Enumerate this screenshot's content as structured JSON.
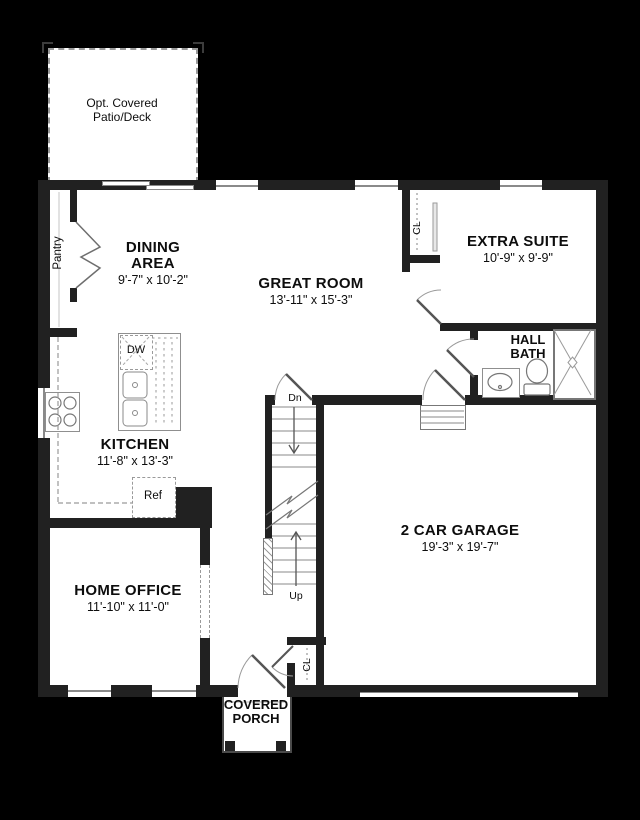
{
  "plan": {
    "type": "first-floor plan",
    "colors": {
      "background": "#000000",
      "walls": "#212121",
      "floor": "#ffffff",
      "fixture_lines": "#8f8f8f",
      "text": "#0d0d0d"
    },
    "rooms": {
      "patio": {
        "line1": "Opt. Covered",
        "line2": "Patio/Deck"
      },
      "pantry": {
        "name": "Pantry"
      },
      "dining": {
        "line1": "DINING",
        "line2": "AREA",
        "dims": "9'-7\" x 10'-2\""
      },
      "great_room": {
        "name": "GREAT ROOM",
        "dims": "13'-11\" x 15'-3\""
      },
      "extra_suite": {
        "name": "EXTRA SUITE",
        "dims": "10'-9\" x 9'-9\""
      },
      "hall_bath": {
        "line1": "HALL",
        "line2": "BATH"
      },
      "kitchen": {
        "name": "KITCHEN",
        "dims": "11'-8\" x 13'-3\""
      },
      "garage": {
        "name": "2 CAR GARAGE",
        "dims": "19'-3\" x 19'-7\""
      },
      "home_office": {
        "name": "HOME OFFICE",
        "dims": "11'-10\" x 11'-0\""
      },
      "covered_porch": {
        "line1": "COVERED",
        "line2": "PORCH"
      }
    },
    "annotations": {
      "dishwasher": "DW",
      "refrigerator": "Ref",
      "suite_closet": "CL",
      "entry_closet": "CL",
      "stairs_down": "Dn",
      "stairs_up": "Up"
    }
  }
}
